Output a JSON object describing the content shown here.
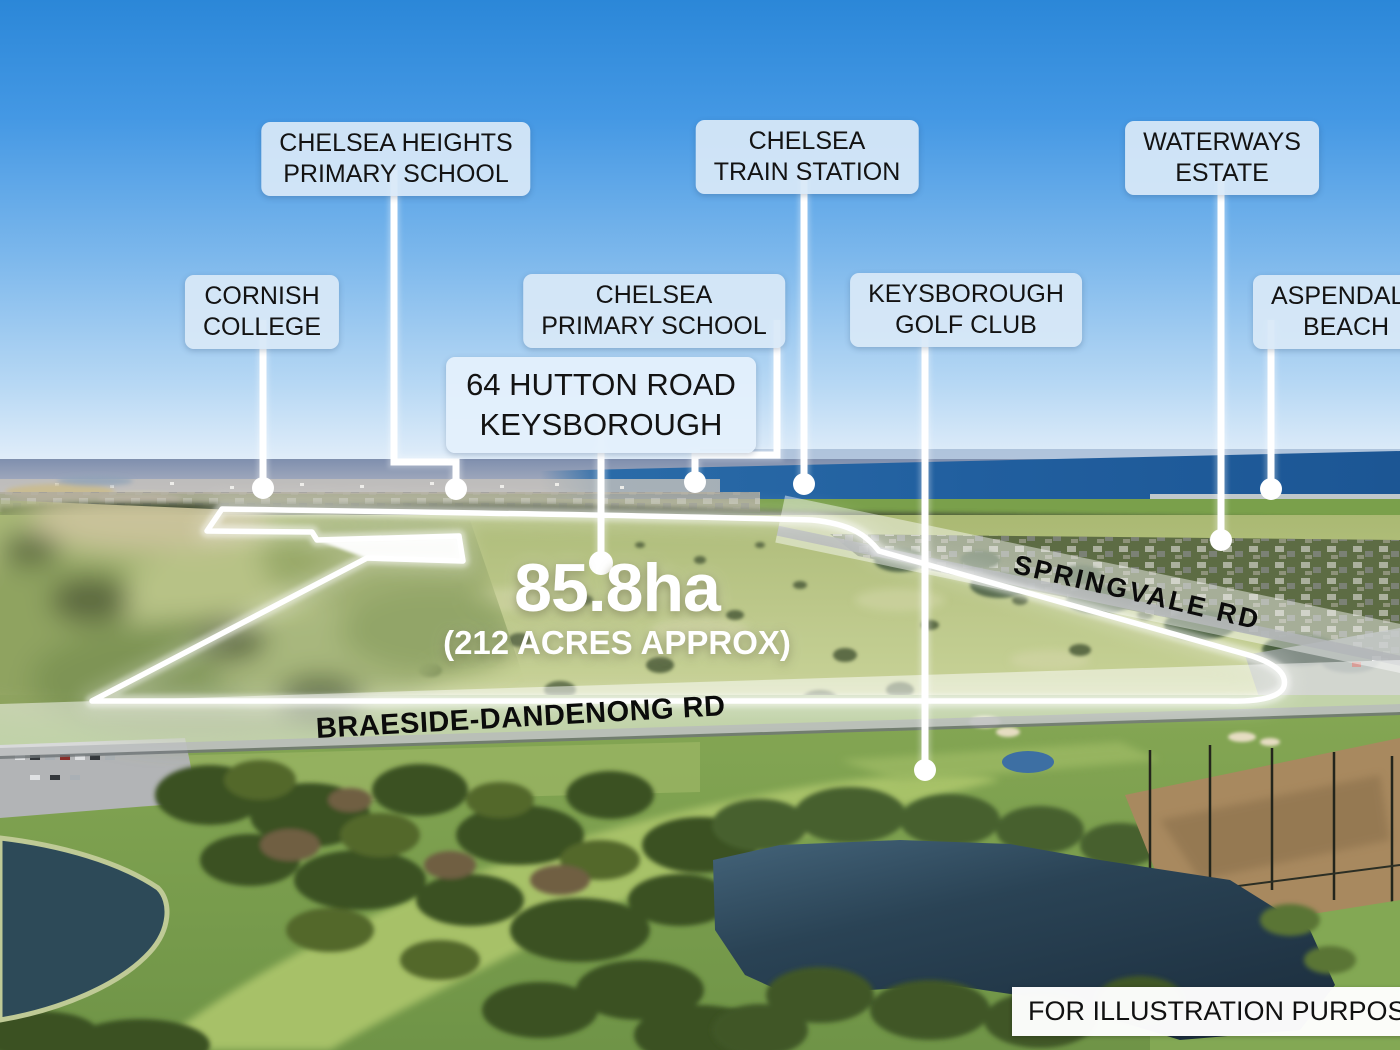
{
  "callouts": [
    {
      "name": "chelsea-heights-primary-school",
      "lines": [
        "CHELSEA HEIGHTS",
        "PRIMARY SCHOOL"
      ]
    },
    {
      "name": "chelsea-train-station",
      "lines": [
        "CHELSEA",
        "TRAIN STATION"
      ]
    },
    {
      "name": "waterways-estate",
      "lines": [
        "WATERWAYS",
        "ESTATE"
      ]
    },
    {
      "name": "cornish-college",
      "lines": [
        "CORNISH",
        "COLLEGE"
      ]
    },
    {
      "name": "chelsea-primary-school",
      "lines": [
        "CHELSEA",
        "PRIMARY SCHOOL"
      ]
    },
    {
      "name": "keysborough-golf-club",
      "lines": [
        "KEYSBOROUGH",
        "GOLF CLUB"
      ]
    },
    {
      "name": "aspendale-beach",
      "lines": [
        "ASPENDALE",
        "BEACH"
      ]
    }
  ],
  "property": {
    "address_line1": "64 HUTTON ROAD",
    "address_line2": "KEYSBOROUGH",
    "area": "85.8ha",
    "area_detail": "(212 ACRES APPROX)"
  },
  "roads": {
    "springvale": "SPRINGVALE RD",
    "braeside_dandenong": "BRAESIDE-DANDENONG RD"
  },
  "disclaimer": "FOR ILLUSTRATION PURPOSE ONLY",
  "colors": {
    "label_bg": "#d9e8f8",
    "boundary_line": "#ffffff",
    "sky_top": "#2b87d8",
    "sea": "#215f9f",
    "lake": "#22394a"
  }
}
